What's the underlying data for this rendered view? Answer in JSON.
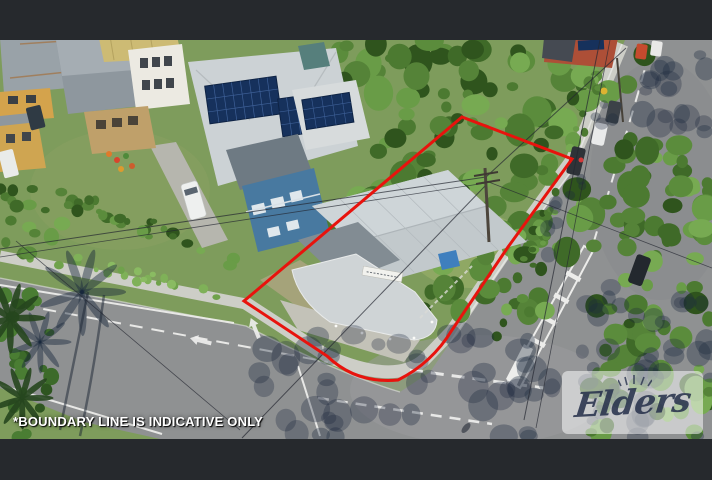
{
  "overlay": {
    "disclaimer": "*BOUNDARY LINE IS INDICATIVE ONLY"
  },
  "watermark": {
    "brand": "Elders"
  },
  "colors": {
    "boundary_red": "#e8130d",
    "letterbox_bar": "#26292d",
    "disclaimer_text": "#ffffff",
    "watermark_text": "#28324c"
  }
}
